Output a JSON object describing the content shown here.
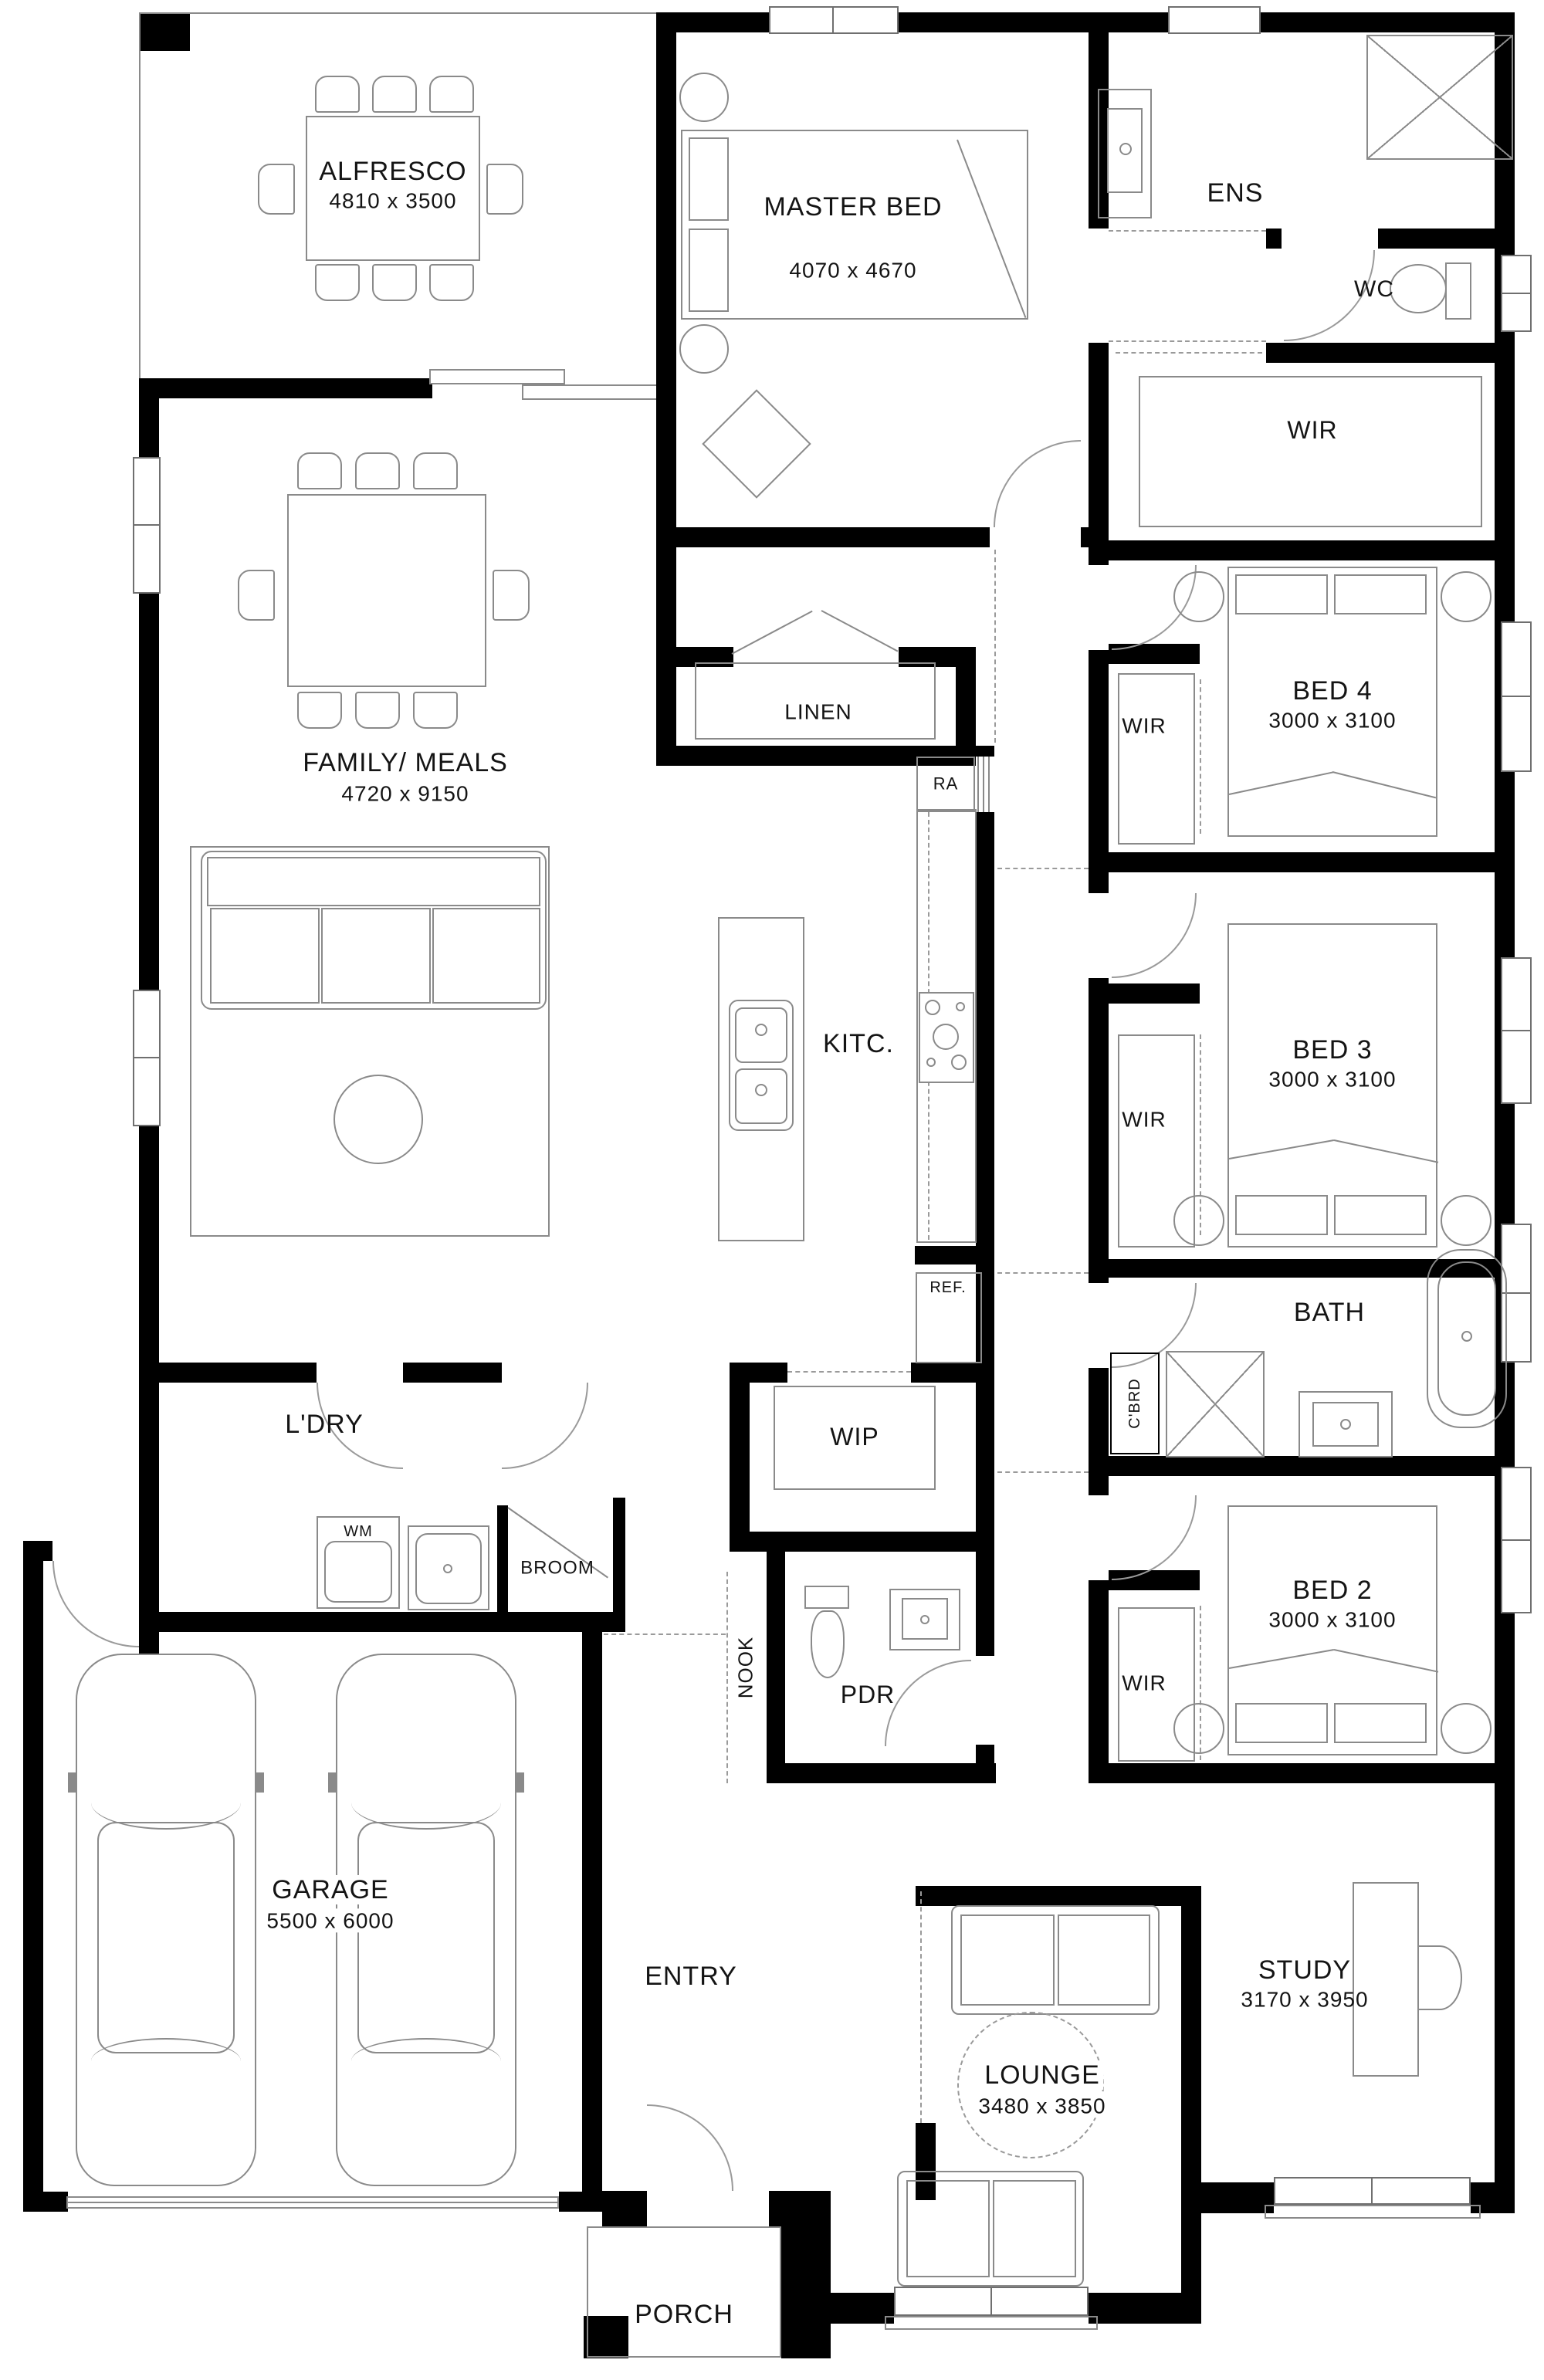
{
  "plan": {
    "type": "architectural-floor-plan",
    "colors": {
      "wall": "#000000",
      "furniture_line": "#8a8a8a",
      "background": "#ffffff",
      "text": "#141414"
    },
    "rooms": {
      "alfresco": {
        "name": "ALFRESCO",
        "dims": "4810 x 3500"
      },
      "master": {
        "name": "MASTER BED",
        "dims": "4070 x 4670"
      },
      "ens": {
        "name": "ENS"
      },
      "wc": {
        "name": "WC"
      },
      "wir_master": {
        "name": "WIR"
      },
      "bed4": {
        "name": "BED 4",
        "dims": "3000 x 3100"
      },
      "wir_bed4": {
        "name": "WIR"
      },
      "linen": {
        "name": "LINEN"
      },
      "ra": {
        "name": "RA"
      },
      "family": {
        "name": "FAMILY/ MEALS",
        "dims": "4720 x 9150"
      },
      "kitchen": {
        "name": "KITC."
      },
      "ref": {
        "name": "REF."
      },
      "bed3": {
        "name": "BED 3",
        "dims": "3000 x 3100"
      },
      "wir_bed3": {
        "name": "WIR"
      },
      "bath": {
        "name": "BATH"
      },
      "cbrd": {
        "name": "C'BRD"
      },
      "ldry": {
        "name": "L'DRY"
      },
      "wm": {
        "name": "WM"
      },
      "broom": {
        "name": "BROOM"
      },
      "wip": {
        "name": "WIP"
      },
      "nook": {
        "name": "NOOK"
      },
      "pdr": {
        "name": "PDR"
      },
      "bed2": {
        "name": "BED 2",
        "dims": "3000 x 3100"
      },
      "wir_bed2": {
        "name": "WIR"
      },
      "garage": {
        "name": "GARAGE",
        "dims": "5500 x 6000"
      },
      "entry": {
        "name": "ENTRY"
      },
      "lounge": {
        "name": "LOUNGE",
        "dims": "3480 x 3850"
      },
      "study": {
        "name": "STUDY",
        "dims": "3170 x 3950"
      },
      "porch": {
        "name": "PORCH"
      }
    }
  }
}
